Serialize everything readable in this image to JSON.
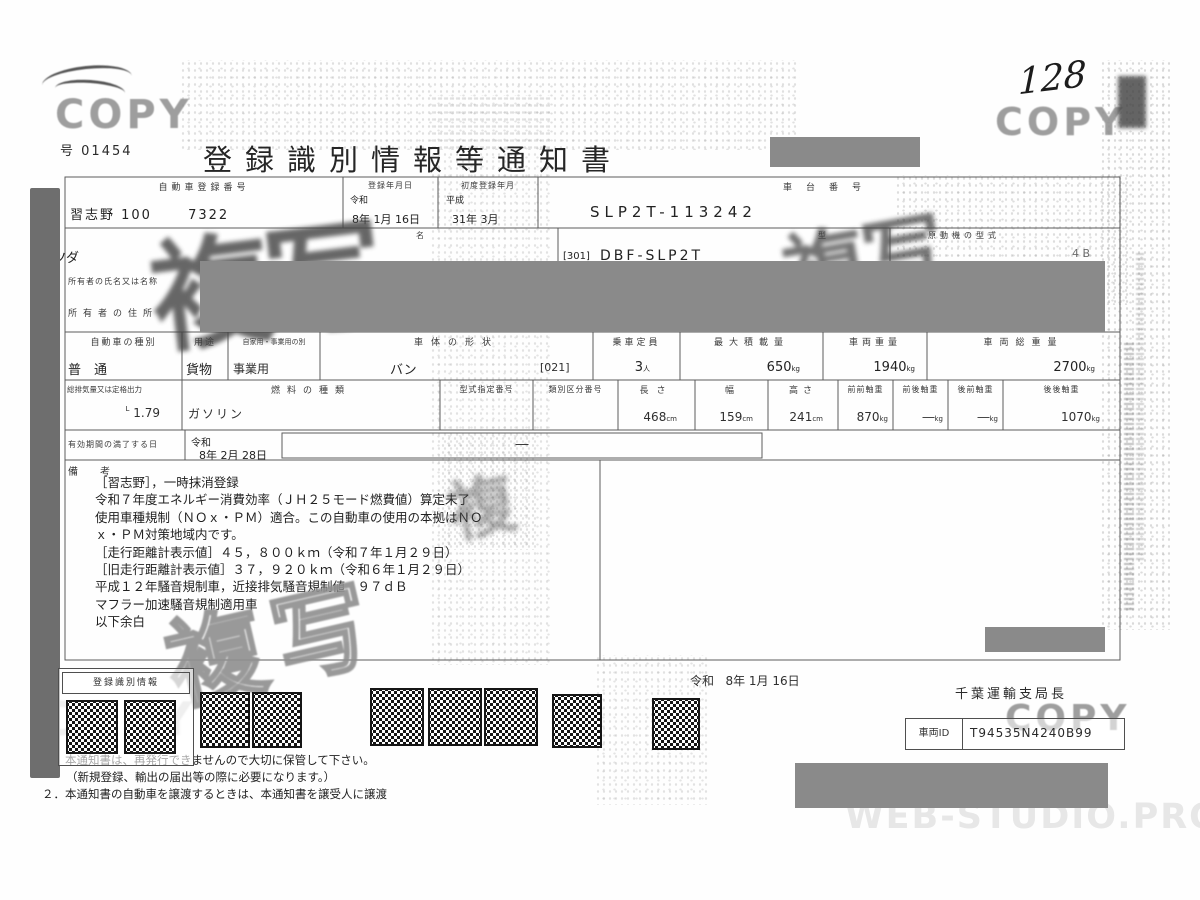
{
  "stamps": {
    "copy": "COPY",
    "duplicate": "複写",
    "duplicate_single": "複",
    "handwritten_number": "128",
    "engine_fragment": "4 B"
  },
  "header": {
    "doc_no_label": "号",
    "doc_no": "01454",
    "title": "登録識別情報等通知書"
  },
  "t1": {
    "h_reg_no": "自動車登録番号",
    "h_reg_date": "登録年月日",
    "h_first_reg": "初度登録年月",
    "h_chassis": "車台番号",
    "v_reg_no": "習志野 100　　 7322",
    "v_reg_era": "令和",
    "v_reg_date": "8年 1月 16日",
    "v_first_era": "平成",
    "v_first_date": "31年 3月",
    "v_chassis": "SLP2T-113242",
    "h_name": "名",
    "h_model": "型",
    "h_engine": "原動機の型式",
    "v_maker": "マツダ",
    "v_model_prefix": "[301]",
    "v_model": "DBF-SLP2T",
    "h_owner_name": "所有者の氏名又は名称",
    "h_owner_addr": "所有者の住所"
  },
  "t2": {
    "h_kind": "自動車の種別",
    "h_use": "用途",
    "h_private": "自家用・事業用の別",
    "h_shape": "車体の形状",
    "h_capacity": "乗車定員",
    "h_max_load": "最大積載量",
    "h_weight": "車両重量",
    "h_gross": "車両総重量",
    "v_kind": "普　通",
    "v_use": "貨物",
    "v_private": "事業用",
    "v_shape": "バン",
    "v_shape_code": "[021]",
    "v_capacity": "3",
    "u_capacity": "人",
    "v_max_load": "650",
    "u_kg": "kg",
    "v_weight": "1940",
    "v_gross": "2700",
    "h_disp": "総排気量又は定格出力",
    "h_fuel": "燃料の種類",
    "h_type_no": "型式指定番号",
    "h_class_no": "類別区分番号",
    "h_length": "長さ",
    "h_width": "幅",
    "h_height": "高さ",
    "h_ff": "前前軸重",
    "h_fr": "前後軸重",
    "h_rf": "後前軸重",
    "h_rr": "後後軸重",
    "v_disp": "1.79",
    "u_disp": "L",
    "v_fuel": "ガソリン",
    "v_length": "468",
    "u_cm": "cm",
    "v_width": "159",
    "v_height": "241",
    "v_ff": "870",
    "v_fr": "―",
    "v_rf": "―",
    "v_rr": "1070",
    "h_expiry": "有効期間の満了する日",
    "v_exp_era": "令和",
    "v_exp_date": "8年 2月 28日",
    "v_exp_dash": "―"
  },
  "remarks": {
    "label": "備　考",
    "lines": [
      "［習志野］，一時抹消登録",
      "令和７年度エネルギー消費効率（ＪＨ２５モード燃費値）算定未了",
      "使用車種規制（ＮＯｘ・ＰＭ）適合。この自動車の使用の本拠はＮＯ",
      "ｘ・ＰＭ対策地域内です。",
      "［走行距離計表示値］４５，８００ｋｍ（令和７年１月２９日）",
      "［旧走行距離計表示値］３７，９２０ｋｍ（令和６年１月２９日）",
      "平成１２年騒音規制車，近接排気騒音規制値　９７ｄＢ",
      "マフラー加速騒音規制適用車",
      "以下余白"
    ]
  },
  "bottom": {
    "reg_info_label": "登録識別情報",
    "issue_era": "令和",
    "issue_date": "8年 1月 16日",
    "issuer": "千葉運輸支局長",
    "vid_label": "車両ID",
    "vid": "T94535N4240B99",
    "notes": [
      "１．本通知書は、再発行できませんので大切に保管して下さい。",
      "（新規登録、輸出の届出等の際に必要になります。）",
      "２．本通知書の自動車を譲渡するときは、本通知書を譲受人に譲渡"
    ],
    "watermark": "WEB-STUDIO.PRO"
  }
}
